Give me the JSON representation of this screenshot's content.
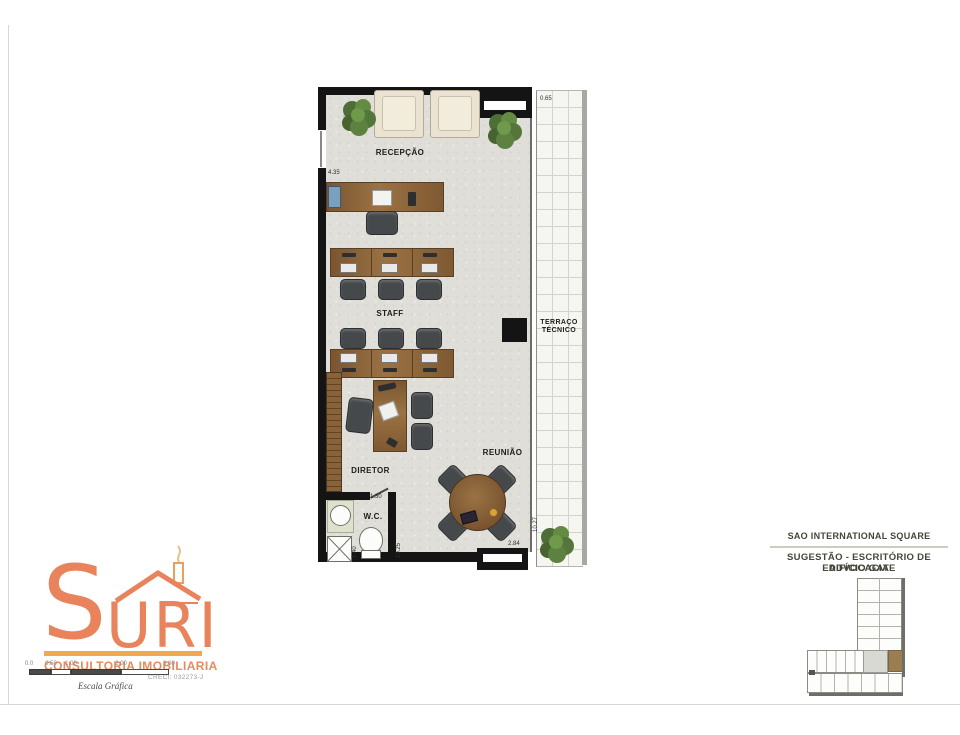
{
  "plan": {
    "room_labels": {
      "recepcao": "RECEPÇÃO",
      "staff": "STAFF",
      "diretor": "DIRETOR",
      "reuniao": "REUNIÃO",
      "wc": "W.C.",
      "terraco_line1": "TERRAÇO",
      "terraco_line2": "TÉCNICO"
    },
    "dims": {
      "terrace_top": "0.65",
      "entry": "4.35",
      "wc_door": "1.30",
      "wc_side": "1.40",
      "wc_right": "10.25",
      "terrace_right": "10.27",
      "bottom": "2.84"
    }
  },
  "logo": {
    "wordmark_s": "S",
    "wordmark_rest": "URI",
    "tagline": "CONSULTORIA IMOBILIARIA",
    "creci": "CRECI: 032273-J",
    "escala": "Escala Gráfica",
    "ticks": [
      "0.0",
      "0.50",
      "1.00",
      "2.00",
      "3.00"
    ]
  },
  "title_block": {
    "project": "SAO INTERNATIONAL SQUARE",
    "line1": "SUGESTÃO - ESCRITÓRIO DE ADVOCACIA",
    "line2": "EDIFÍCIO GATE"
  },
  "colors": {
    "logo_orange": "#E8835C",
    "logo_bar_orange": "#F2A852",
    "wood": "#8A6239",
    "chair_gray": "#46494B",
    "unit_highlight": "#9A7E52",
    "wall_black": "#141414"
  }
}
